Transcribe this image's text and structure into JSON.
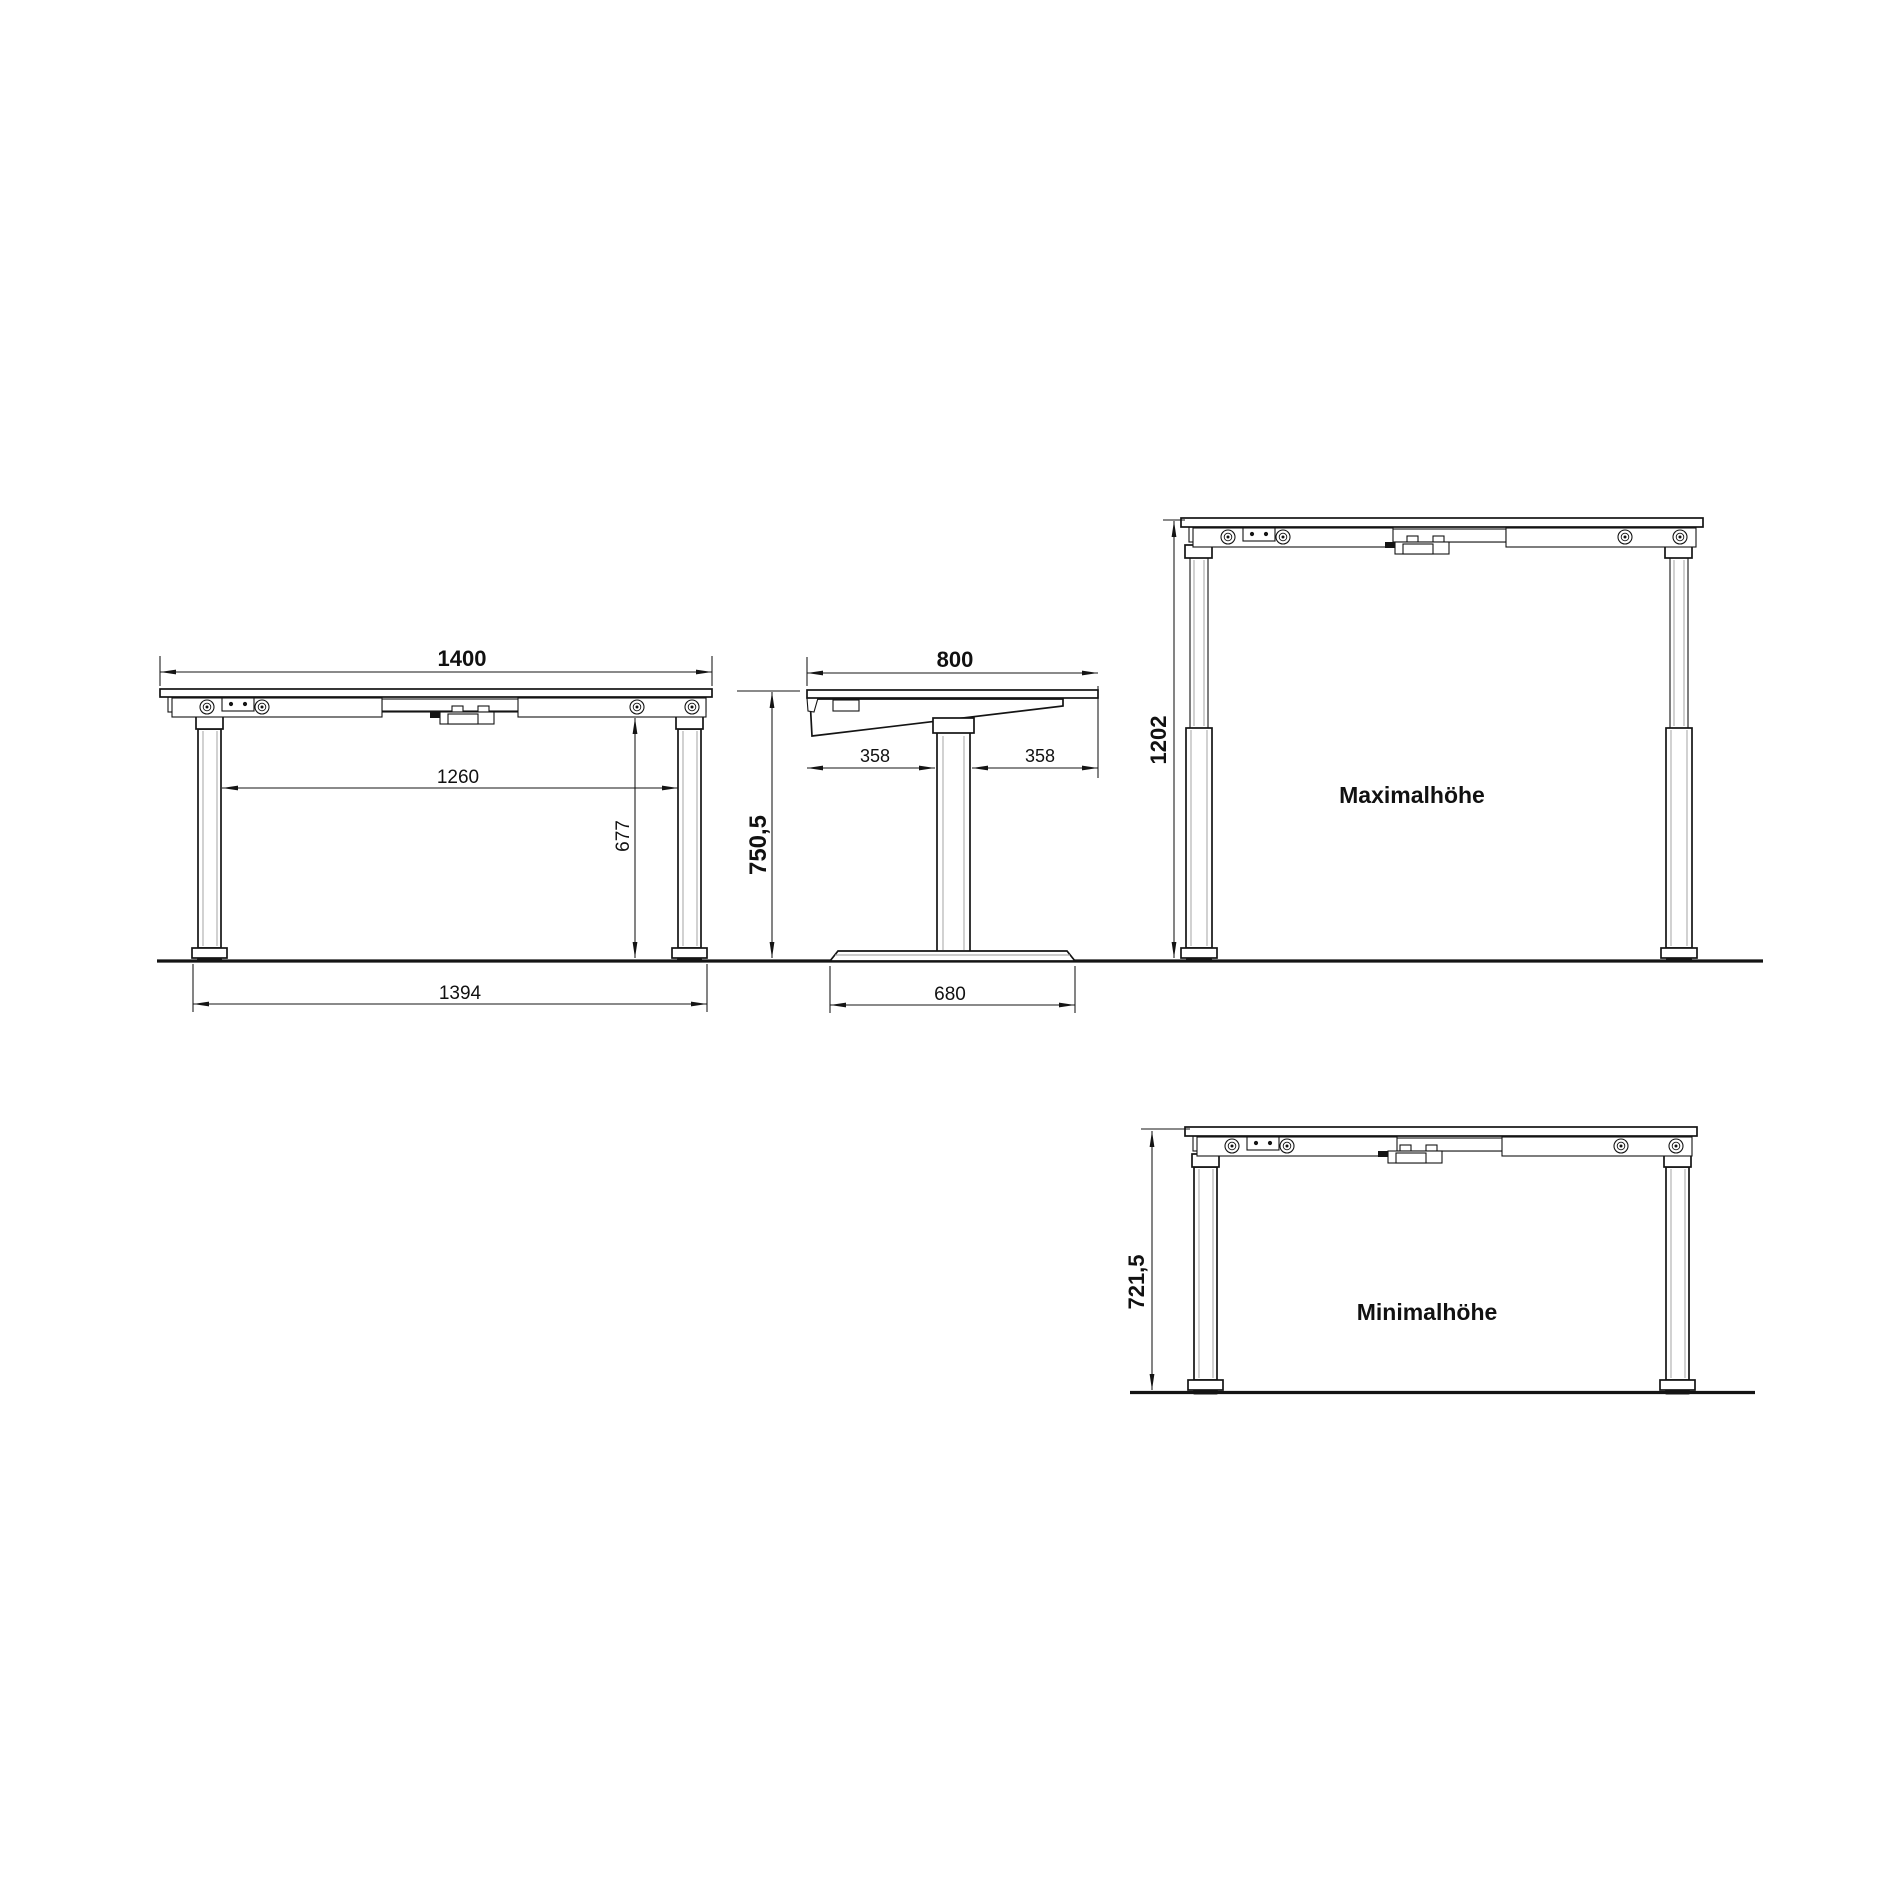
{
  "drawing": {
    "front_view": {
      "top_width": "1400",
      "inner_width": "1260",
      "frame_height": "677",
      "foot_width": "1394"
    },
    "side_view": {
      "top_depth": "800",
      "left_offset": "358",
      "right_offset": "358",
      "total_height": "750,5",
      "base_depth": "680"
    },
    "max_view": {
      "height": "1202",
      "label": "Maximalhöhe"
    },
    "min_view": {
      "height": "721,5",
      "label": "Minimalhöhe"
    }
  }
}
